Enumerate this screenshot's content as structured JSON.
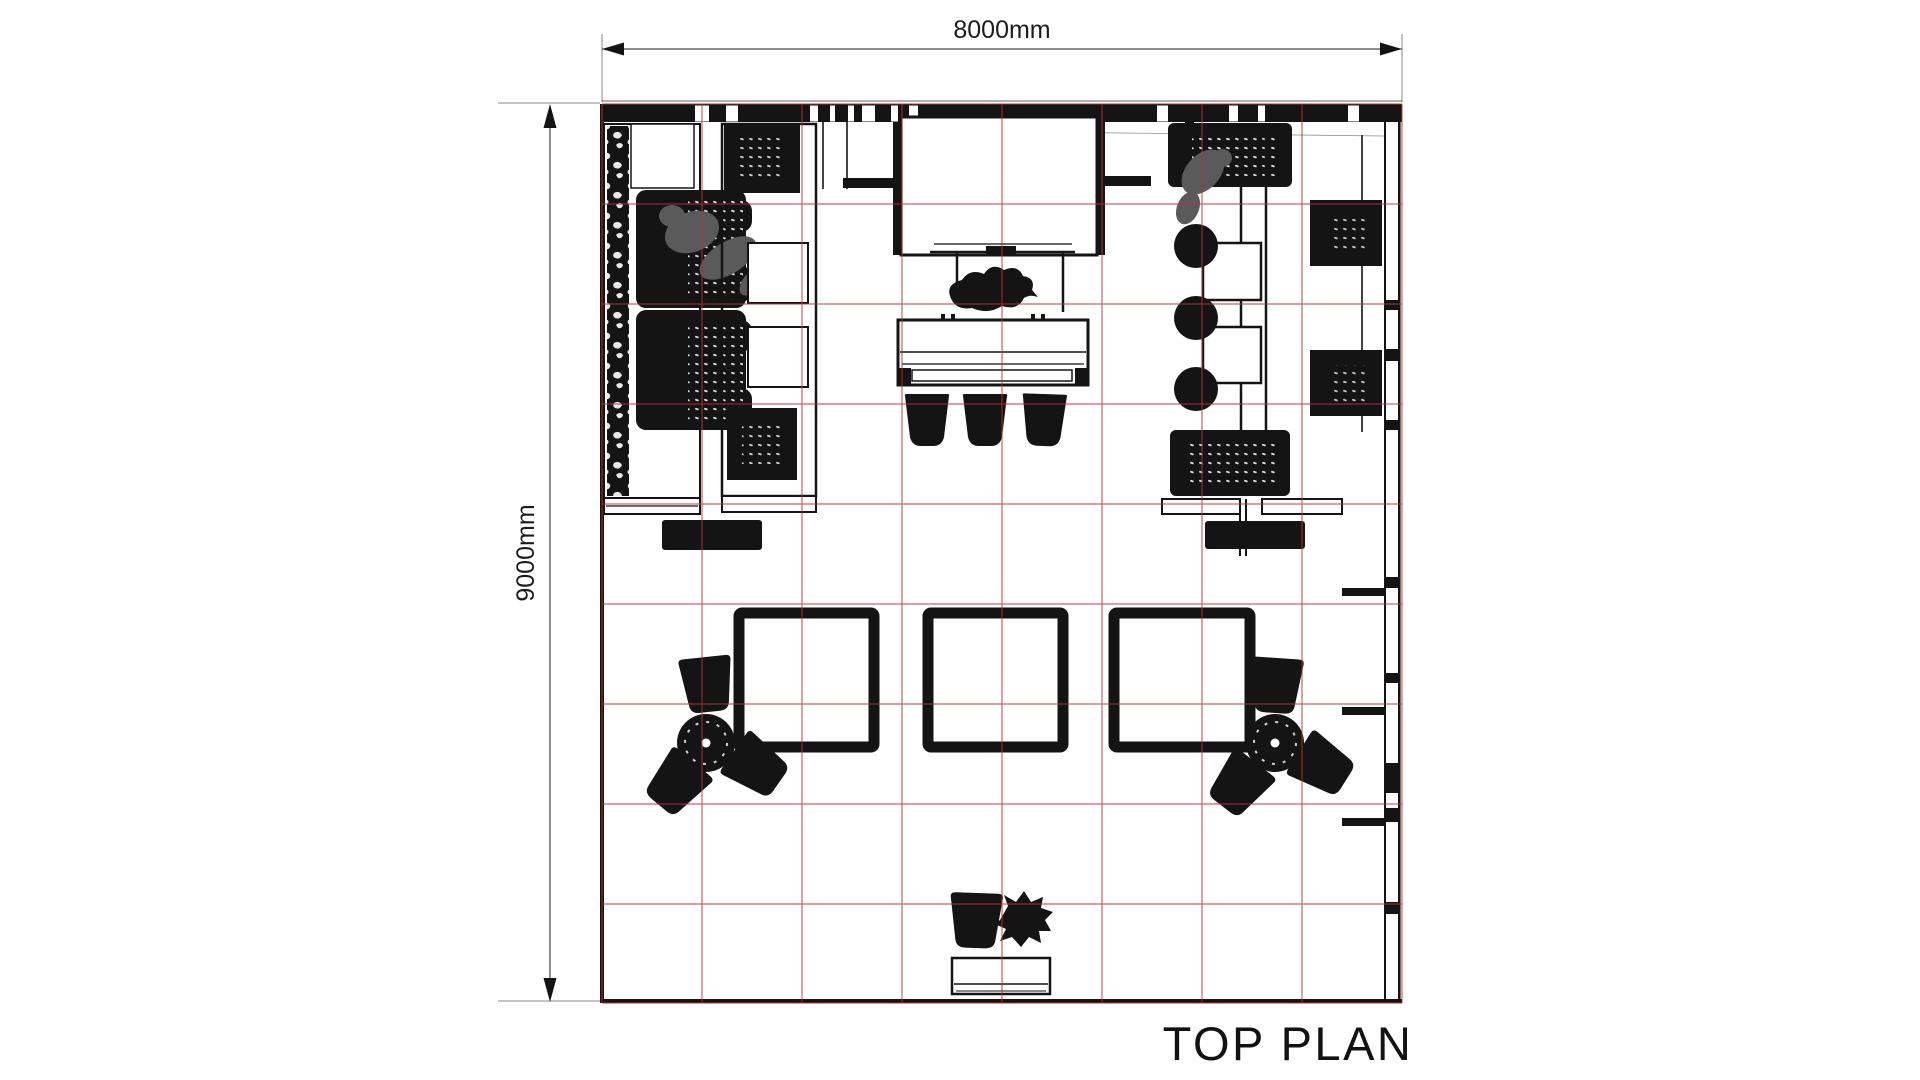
{
  "title": {
    "text": "TOP PLAN"
  },
  "dimensions": {
    "width_label": "8000mm",
    "height_label": "9000mm"
  },
  "plan": {
    "grid_columns": 8,
    "grid_rows": 9
  },
  "colors": {
    "ink": "#141414",
    "grid_red": "#bc3030",
    "figure_gray": "#5a5a5a",
    "background": "#ffffff",
    "dim_text": "#1c1c1c"
  }
}
